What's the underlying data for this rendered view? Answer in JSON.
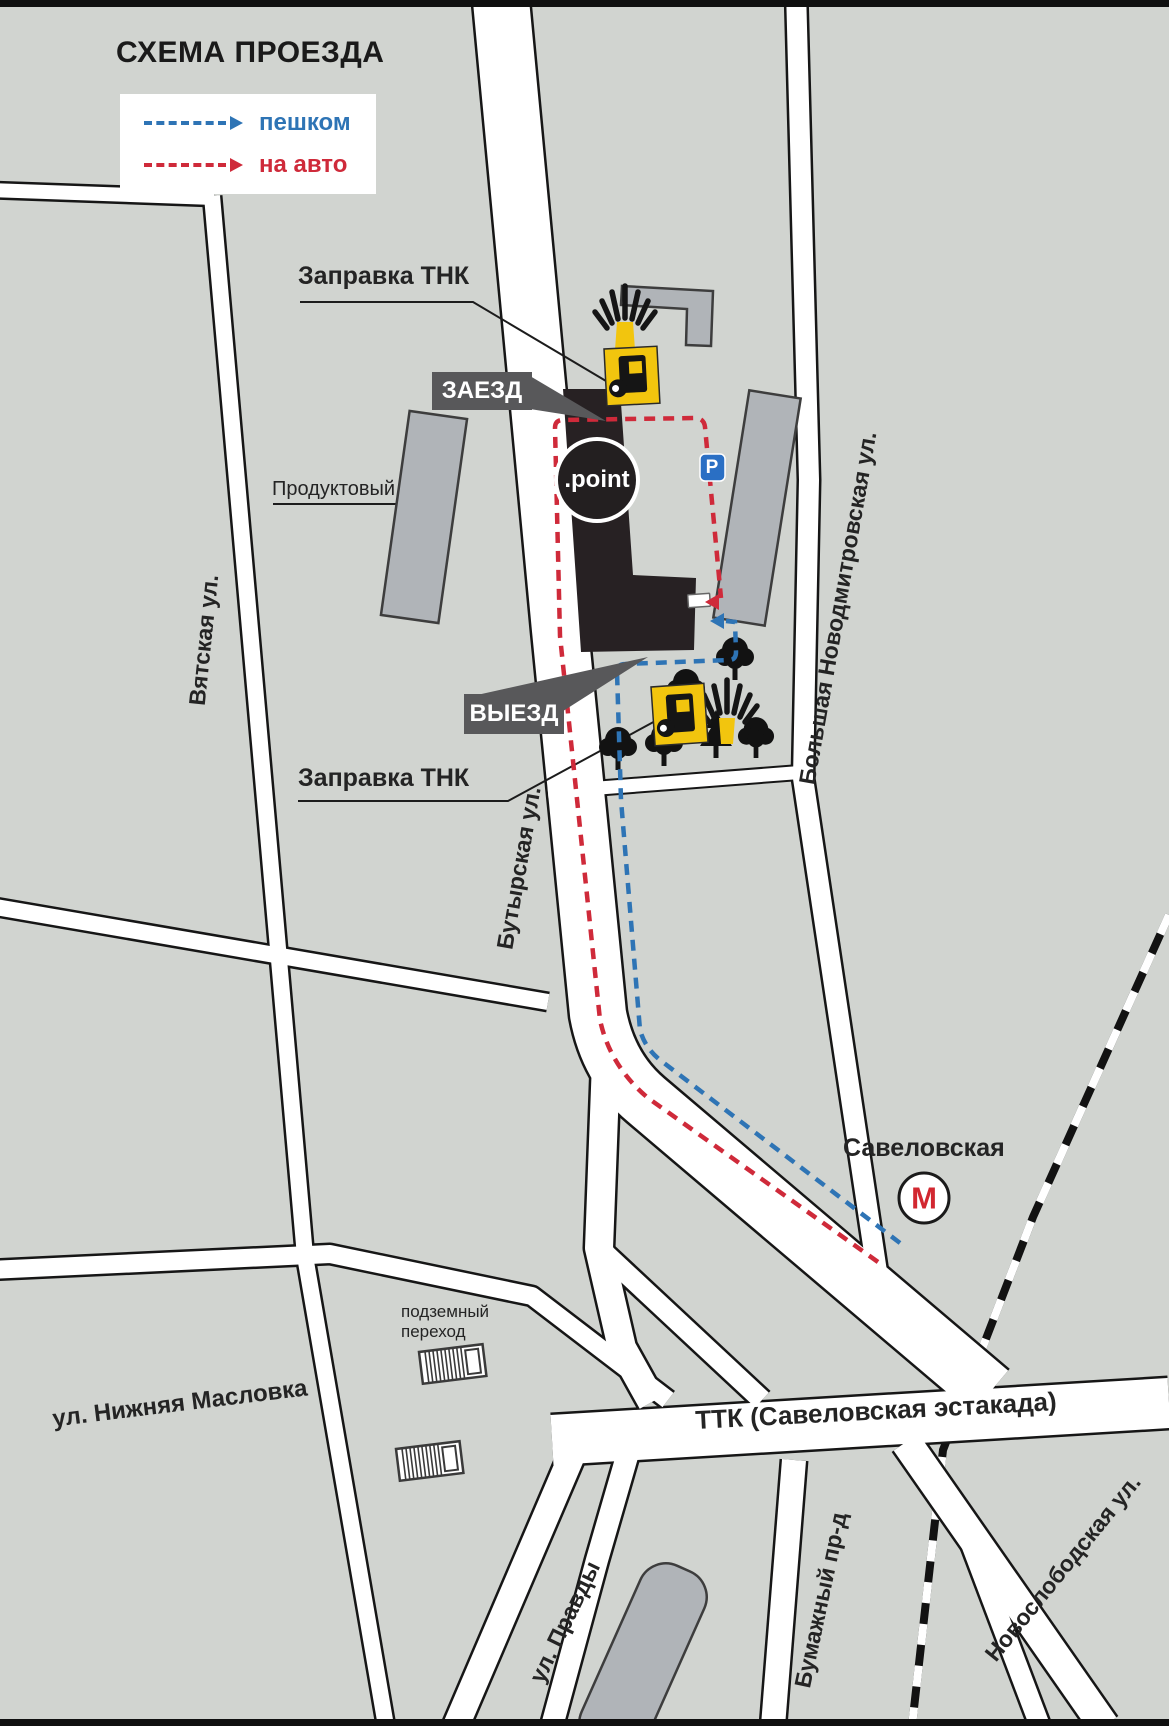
{
  "title": "СХЕМА ПРОЕЗДА",
  "legend": {
    "walk": {
      "label": "пешком"
    },
    "car": {
      "label": "на авто"
    }
  },
  "markers": {
    "gas_top": "Заправка ТНК",
    "gas_bottom": "Заправка ТНК",
    "entry": "ЗАЕЗД",
    "exit": "ВЫЕЗД",
    "grocery": "Продуктовый",
    "logo": ".point",
    "parking": "P",
    "underpass": "подземный переход",
    "metro_station": "Савеловская",
    "metro_letter": "М"
  },
  "streets": {
    "vyatskaya": "Вятская ул.",
    "butyrskaya": "Бутырская ул.",
    "bolshaya_novodmitrovskaya": "Большая Новодмитровская ул.",
    "nizhnyaya_maslovka": "ул. Нижняя Масловка",
    "ttk": "ТТК (Савеловская эстакада)",
    "pravdy": "ул. Правды",
    "bumazhny": "Бумажный пр-д",
    "novoslobodskaya": "Новослободская ул."
  },
  "icons": {
    "gas": "fuel-pump-icon",
    "flame": "tnk-flame-icon",
    "metro": "metro-m-icon",
    "parking": "parking-p-icon",
    "underpass": "underpass-stairs-icon",
    "trees": "tree-icons",
    "railroad": "railroad-hatched-line"
  },
  "colors": {
    "background": "#d1d4d0",
    "road_fill": "#ffffff",
    "road_casing": "#161616",
    "building_gray": "#b0b4b8",
    "building_dark": "#272123",
    "label_box": "#58585a",
    "route_walk": "#2e74b5",
    "route_car": "#cf2a3a",
    "gas_yellow": "#f2c50e",
    "parking_blue": "#2a6fc4",
    "metro_red": "#d22730"
  }
}
